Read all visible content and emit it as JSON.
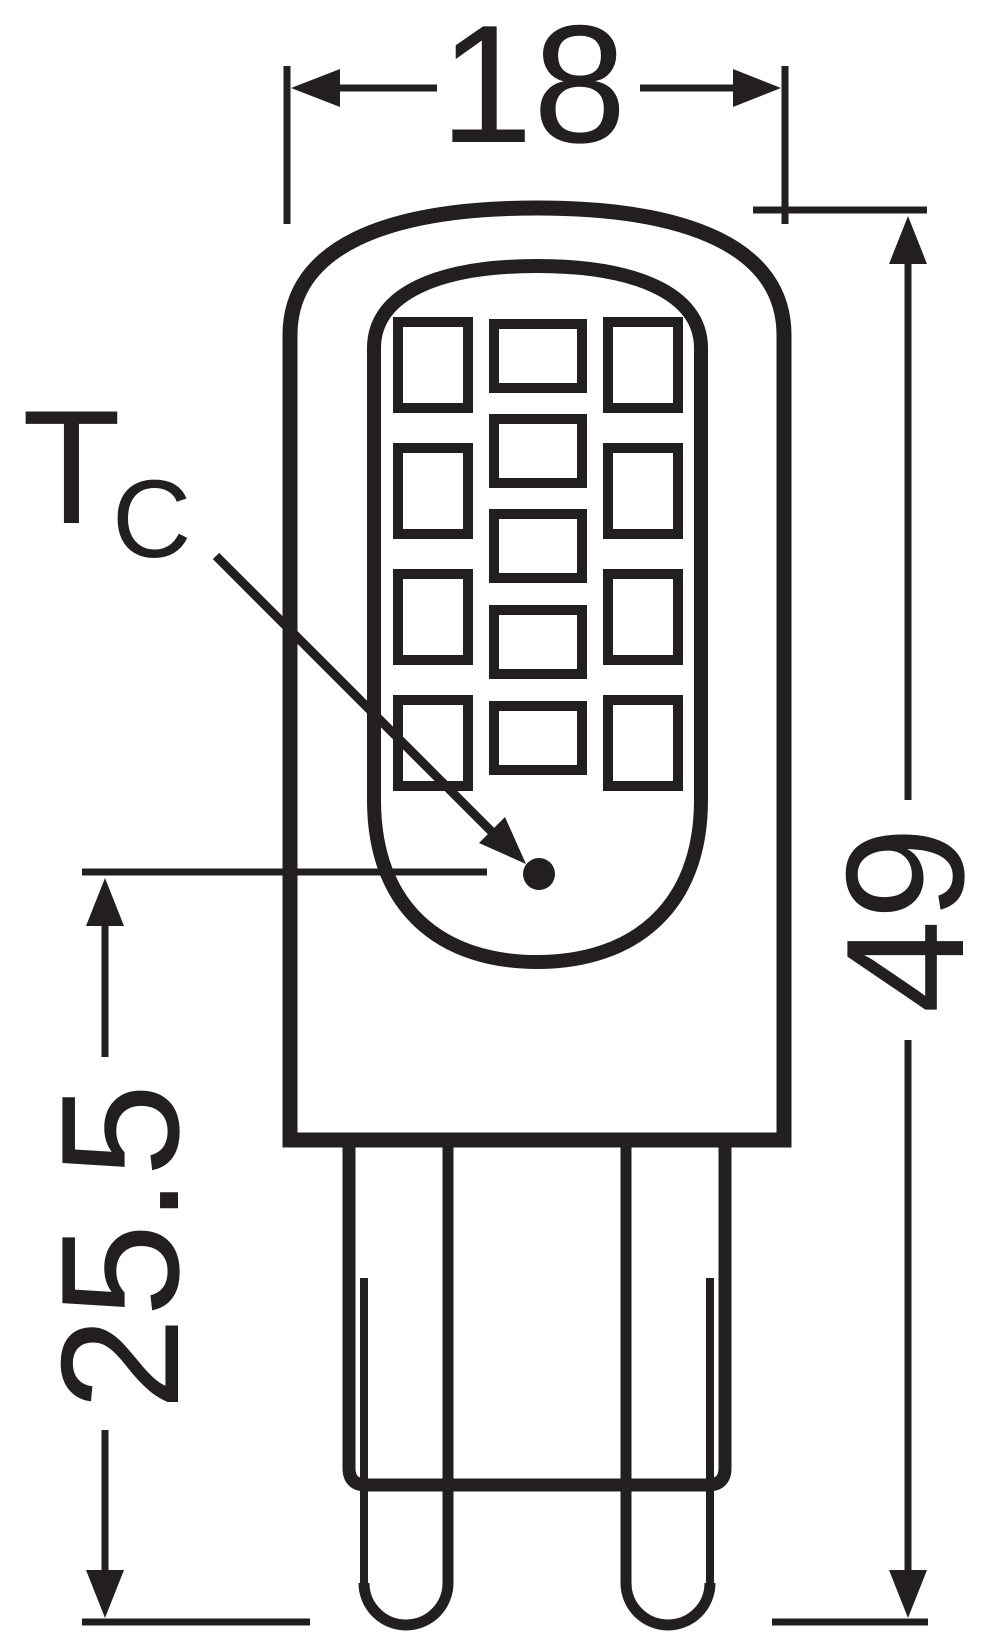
{
  "drawing": {
    "line_color": "#231f20",
    "background_color": "#ffffff"
  },
  "dimensions": {
    "width": {
      "value": "18"
    },
    "overall_length": {
      "value": "49"
    },
    "tc_point_distance": {
      "value": "25.5"
    }
  },
  "tc_label": {
    "symbol": "T",
    "subscript": "C"
  },
  "led_grid": {
    "column_counts": [
      4,
      5,
      4
    ],
    "total_chips": 13
  }
}
